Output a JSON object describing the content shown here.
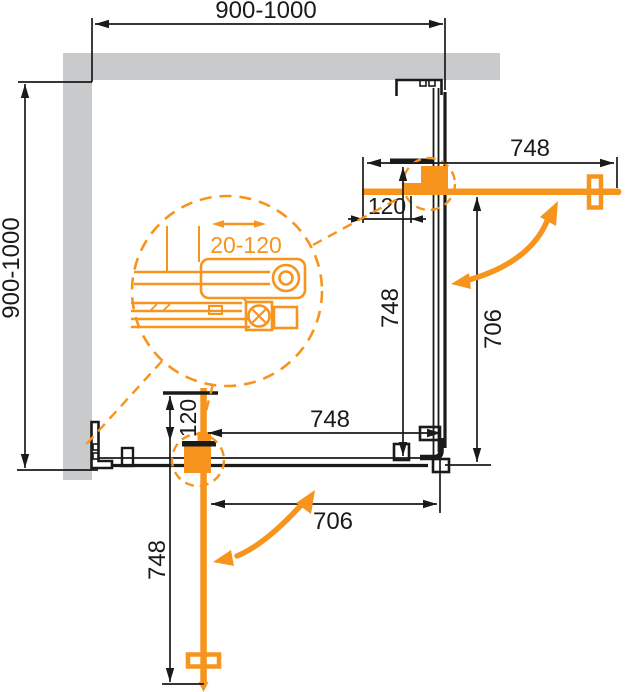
{
  "drawing_title": "Corner shower enclosure plan - technical dimension drawing",
  "colors": {
    "accent_orange": "#F6941E",
    "line_black": "#1A1A1A",
    "wall_gray": "#C9CACC"
  },
  "dimensions": {
    "top_width": "900-1000",
    "left_depth": "900-1000",
    "top_door_length": "748",
    "top_door_pivot_offset": "120",
    "right_pivot_to_panel": "748",
    "right_opening": "706",
    "bottom_door_length": "748",
    "bottom_door_pivot_offset": "120",
    "bottom_pivot_to_panel": "748",
    "bottom_opening": "706",
    "profile_adjustment_range": "20-120"
  }
}
